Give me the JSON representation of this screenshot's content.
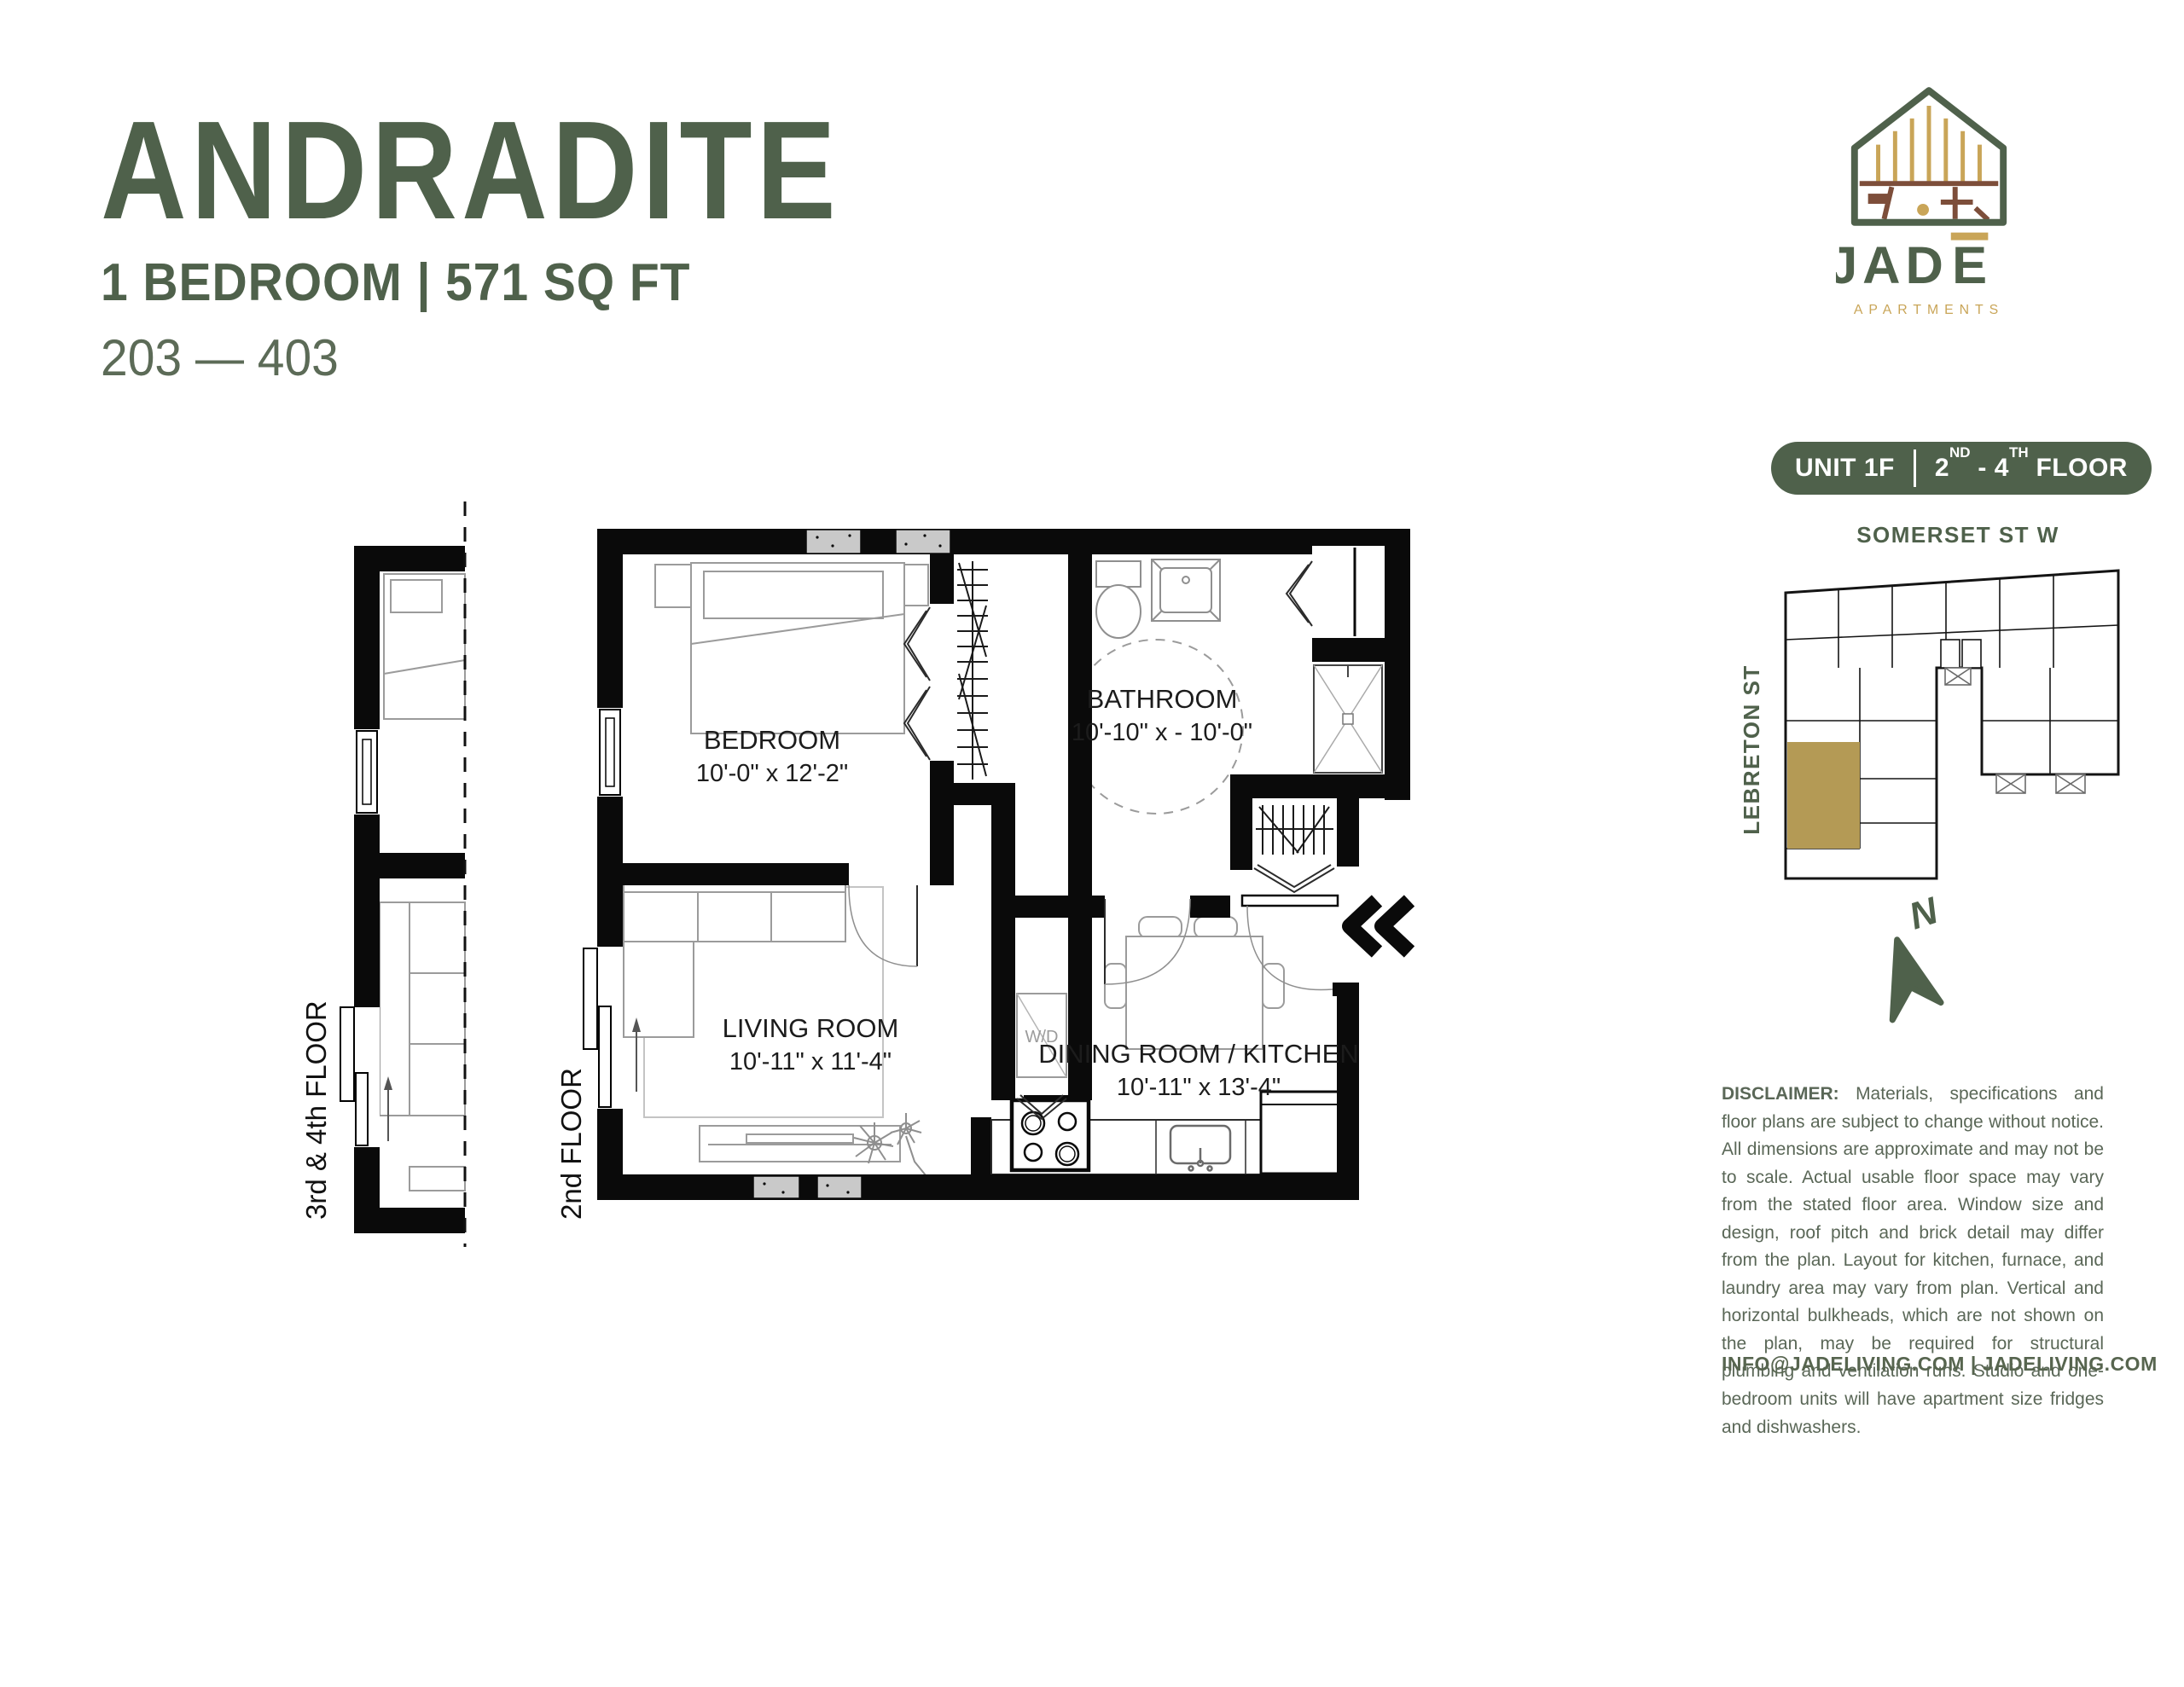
{
  "header": {
    "title": "ANDRADITE",
    "subtitle": "1 BEDROOM | 571 SQ FT",
    "unit_range": "203 — 403"
  },
  "logo": {
    "wordmark_prefix": "JAD",
    "wordmark_last": "E",
    "tagline": "APARTMENTS"
  },
  "unit_badge": {
    "unit": "UNIT 1F",
    "floor_num1": "2",
    "floor_sup1": "ND",
    "floor_mid": " - 4",
    "floor_sup2": "TH",
    "floor_tail": " FLOOR"
  },
  "location_map": {
    "street_top": "SOMERSET ST W",
    "street_left": "LEBRETON ST",
    "north": "N"
  },
  "floor_plan": {
    "left_fragment_label": "3rd & 4th FLOOR",
    "main_label": "2nd FLOOR",
    "rooms": {
      "bedroom": {
        "name": "BEDROOM",
        "dims": "10'-0\" x 12'-2\""
      },
      "bathroom": {
        "name": "BATHROOM",
        "dims": "10'-10\" x - 10'-0\""
      },
      "living_room": {
        "name": "LIVING ROOM",
        "dims": "10'-11\" x 11'-4\""
      },
      "dining_kitchen": {
        "name": "DINING ROOM / KITCHEN",
        "dims": "10'-11\" x 13'-4\""
      }
    },
    "labels": {
      "washer_dryer": "W/D"
    }
  },
  "disclaimer": {
    "label": "DISCLAIMER:",
    "body": " Materials, specifications and floor plans are subject to change without notice. All dimensions are approximate and may not be to scale. Actual usable floor space may vary from the stated floor area. Window size and design, roof pitch and brick detail may differ from the plan. Layout for kitchen, furnace, and laundry area may vary from plan. Vertical and horizontal bulkheads, which are not shown on the plan, may be required for structural plumbing and ventilation runs. Studio and one-bedroom units will have apartment size fridges and dishwashers."
  },
  "footer": {
    "contact": "INFO@JADELIVING.COM | JADELIVING.COM"
  },
  "colors": {
    "brand_green": "#4f614b",
    "text_green": "#5a6757",
    "gold": "#c9a558",
    "map_gold": "#b49a55",
    "brown": "#7d4e3a"
  }
}
